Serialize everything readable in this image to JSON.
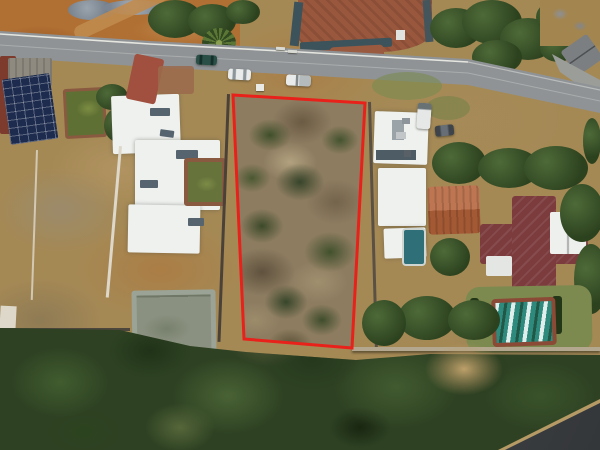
{
  "scene": {
    "type": "aerial-drone-photograph",
    "description": "Top-down aerial photo of a vacant residential stand of dry scrub outlined in red, flanked by suburban houses with pools, a tarred street with parked vehicles along the top, and dense hillside bush across the bottom with a second road clipping the lower-right corner.",
    "visible_text": "none"
  },
  "colors": {
    "red_outline": "#e8211b",
    "road_asphalt": "#8f9396",
    "road_edge_line": "#e6e6e0",
    "road_center_line": "#d8d8d2",
    "lower_road_asphalt": "#45494d",
    "verge_dirt": "#b06f33",
    "plot_scrub": "#8d7c60",
    "bush_dark": "#2e4223",
    "dry_grass": "#bda06a",
    "white_roof": "#eff1ef",
    "slate_accent": "#55646f",
    "gray_roof": "#7b7f82",
    "orange_roof": "#b5633a",
    "maroon_roof": "#7c3c3e",
    "brick_paving": "#99573d",
    "red_ramp": "#a14f3e",
    "redbrown_structure": "#7c3b2c",
    "wall_slate": "#3d535b",
    "wall_white": "#ded8cb",
    "wall_stone": "#b3a88f",
    "solar_panel": "#1c2b4e",
    "pool_green": "#5f7034",
    "mansion_pool_green": "#66743c",
    "pool_teal": "#2e6f78",
    "pool_cover_teal": "#2f8a7e",
    "concrete_pool": "#8b9180",
    "lawn": "#7d8a4f",
    "car_teal": "#2a4f47",
    "car_white": "#e8ebea",
    "van_white": "#e6e8e7",
    "car_dark": "#3f444a"
  },
  "objects": [
    {
      "name": "vacant-plot",
      "description": "rectangular stand of dry veld scrub and bushes outlined by the red boundary overlay"
    },
    {
      "name": "red-boundary-outline",
      "description": "bright red quadrilateral marking the advertised stand"
    },
    {
      "name": "street",
      "description": "tarred street across the top with white edge line, descending to the right"
    },
    {
      "name": "dark-teal-sedan",
      "description": "dark sedan parked on the street"
    },
    {
      "name": "white-sedan",
      "description": "white sedan parked on the gravel verge"
    },
    {
      "name": "white-bakkie",
      "description": "white pickup parked on the verge at the stand frontage"
    },
    {
      "name": "white-van",
      "description": "white van parked beside the house east of the stand"
    },
    {
      "name": "dark-car",
      "description": "dark car parked near the white van"
    },
    {
      "name": "white-mansion",
      "description": "large white multi-wing house with slate accents west of the stand"
    },
    {
      "name": "mansion-pool",
      "description": "green-water pool with brick surround beside the mansion"
    },
    {
      "name": "solar-panel-array",
      "description": "dark rooftop solar panels on the far-west house"
    },
    {
      "name": "west-pool",
      "description": "second green pool on the far-west property"
    },
    {
      "name": "old-concrete-reservoir",
      "description": "empty concrete pool structure on bare ground south of the mansion"
    },
    {
      "name": "white-house-east",
      "description": "white double-storey house immediately east of the stand"
    },
    {
      "name": "orange-tile-roof-house",
      "description": "house with orange tiled roof east of the stand"
    },
    {
      "name": "maroon-roof-house",
      "description": "cross-shaped maroon-roofed house with white gable wing"
    },
    {
      "name": "covered-pool",
      "description": "pool with striped teal cover and brick surround set in a lawn"
    },
    {
      "name": "small-teal-pool",
      "description": "small teal plunge pool west of the houses"
    },
    {
      "name": "brick-driveway",
      "description": "brick-paved driveway court with slate walls across the street"
    },
    {
      "name": "rubble-piles",
      "description": "grey rubble piles and a dirt track on bare ground across the street"
    },
    {
      "name": "palm-tree",
      "description": "palm tree on the upper verge"
    },
    {
      "name": "tree-canopy",
      "description": "numerous dark green trees and shrubs between properties"
    },
    {
      "name": "hillside-bush",
      "description": "dense natural bush covering the lower slope of the image"
    },
    {
      "name": "dry-grass-patch",
      "description": "pale dry-grass clearing within the bush"
    },
    {
      "name": "lower-road",
      "description": "second tarred road clipping the bottom-right corner"
    },
    {
      "name": "boundary-walls",
      "description": "white, dark and stone boundary walls between the properties"
    },
    {
      "name": "sign-board",
      "description": "small white board on the verge at the stand corner"
    }
  ]
}
